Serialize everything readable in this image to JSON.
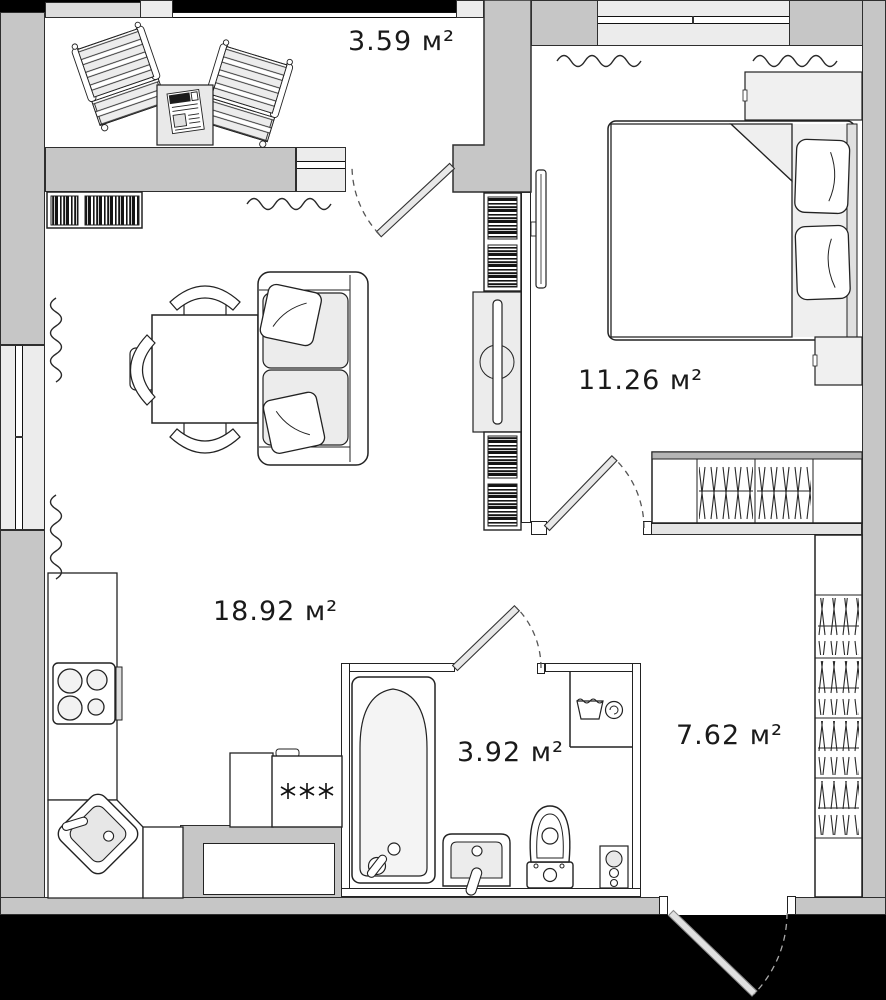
{
  "plan": {
    "colors": {
      "wall": "#c6c6c6",
      "floor": "#ffffff",
      "outside": "#000000",
      "furniture_light": "#ececec",
      "line": "#222222"
    },
    "rooms": {
      "balcony": {
        "area": "3.59 м²"
      },
      "bedroom": {
        "area": "11.26 м²"
      },
      "living_kitchen": {
        "area": "18.92 м²"
      },
      "bathroom": {
        "area": "3.92 м²"
      },
      "hallway": {
        "area": "7.62 м²"
      }
    },
    "symbols": {
      "appliance_stars": "✳✳✳"
    }
  }
}
